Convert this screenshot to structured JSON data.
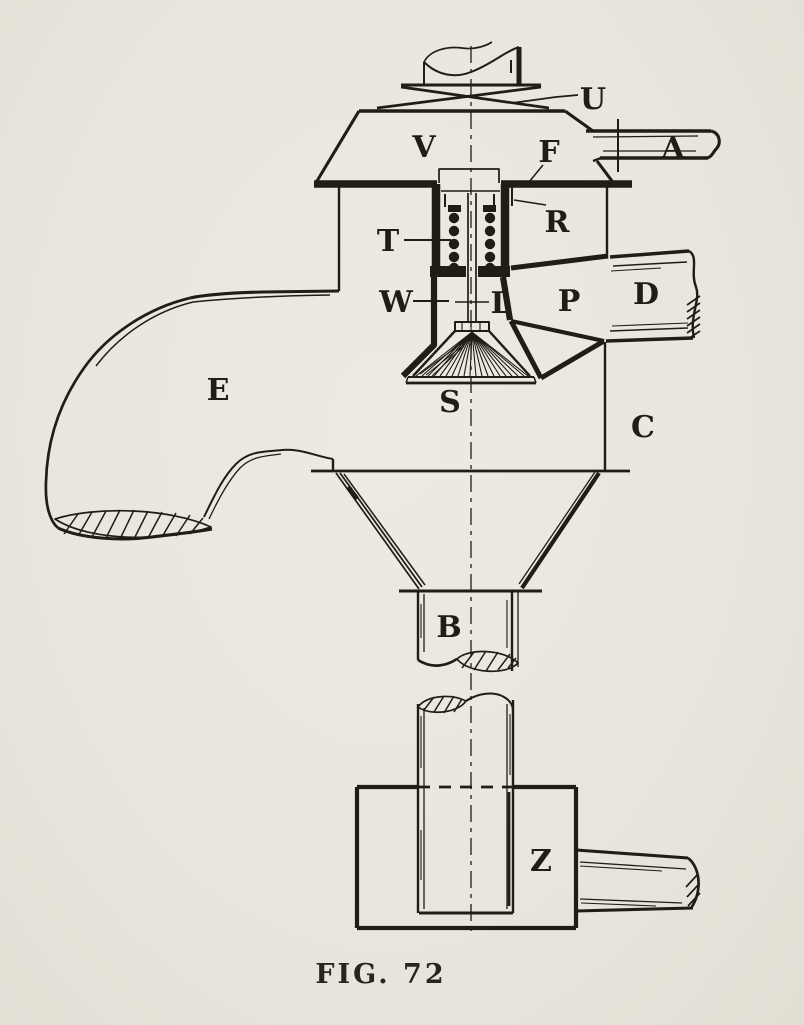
{
  "figure": {
    "caption": "FIG. 72",
    "labels": {
      "U": "U",
      "V": "V",
      "F": "F",
      "A": "A",
      "T": "T",
      "R": "R",
      "W": "W",
      "L": "L",
      "P": "P",
      "D": "D",
      "E": "E",
      "S": "S",
      "C": "C",
      "B": "B",
      "Z": "Z"
    },
    "colors": {
      "paper": "#e9e6de",
      "ink": "#211c15"
    }
  }
}
